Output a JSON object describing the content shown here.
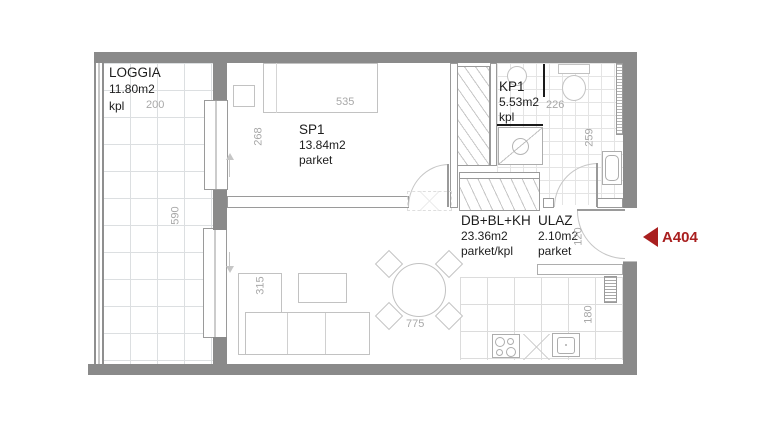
{
  "unit": {
    "code": "A404"
  },
  "rooms": [
    {
      "id": "loggia",
      "name": "LOGGIA",
      "area": "11.80m2",
      "floor": "kpl"
    },
    {
      "id": "sp1",
      "name": "SP1",
      "area": "13.84m2",
      "floor": "parket"
    },
    {
      "id": "kp1",
      "name": "KP1",
      "area": "5.53m2",
      "floor": "kpl"
    },
    {
      "id": "db",
      "name": "DB+BL+KH",
      "area": "23.36m2",
      "floor": "parket/kpl"
    },
    {
      "id": "ulaz",
      "name": "ULAZ",
      "area": "2.10m2",
      "floor": "parket"
    }
  ],
  "dims": {
    "loggia_width": "200",
    "loggia_height": "590",
    "sp1_width": "535",
    "sp1_height": "268",
    "kp1_width": "226",
    "kp1_height": "259",
    "ulaz_width": "120",
    "sofa_depth": "315",
    "dining_width": "775",
    "kitchen_depth": "180"
  },
  "colors": {
    "wall": "#8a8a8a",
    "accent": "#a91f1f"
  }
}
